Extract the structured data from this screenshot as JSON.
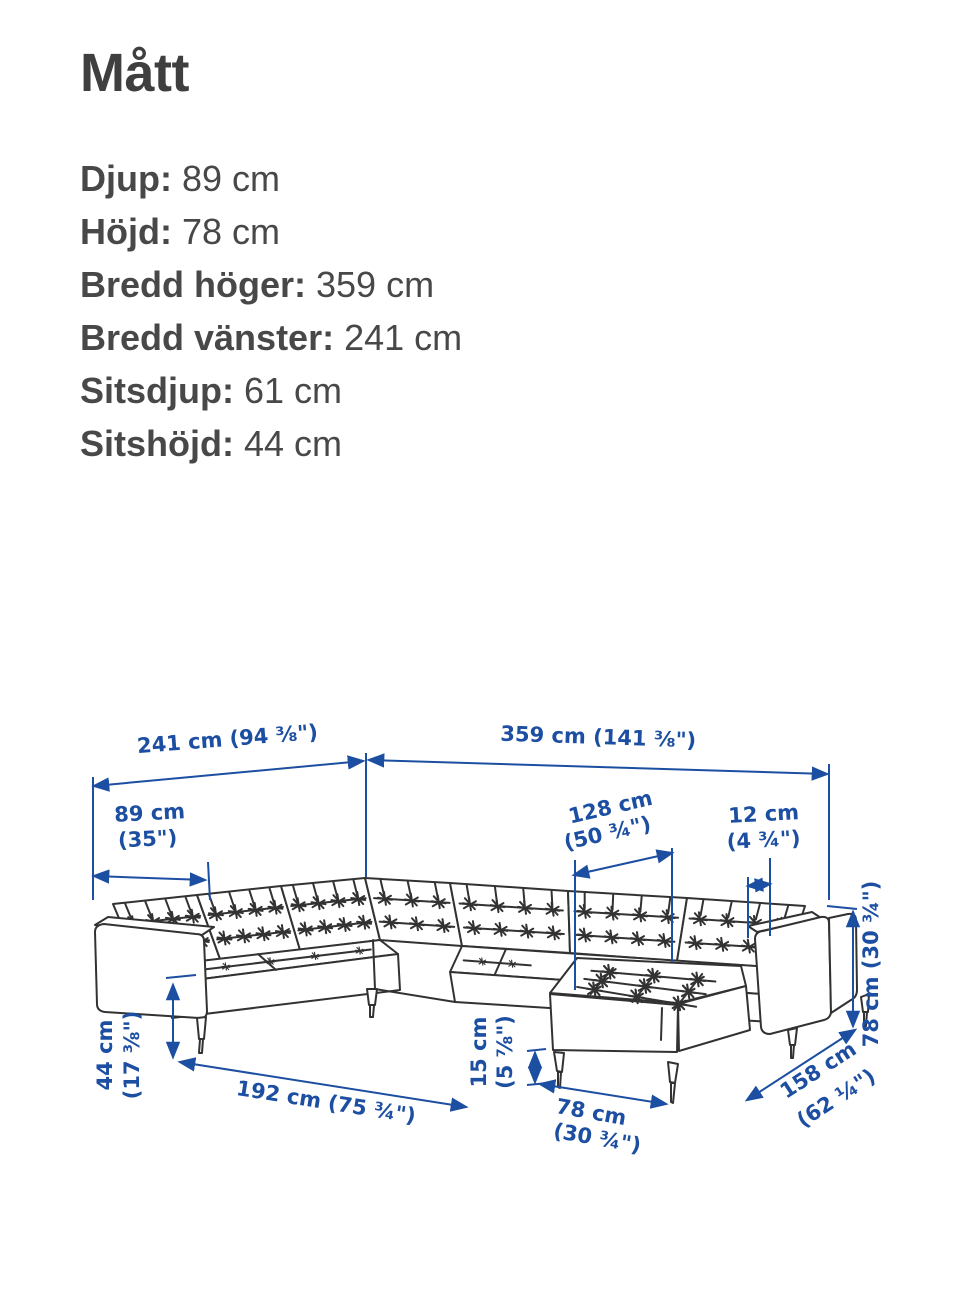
{
  "page": {
    "title": "Mått"
  },
  "specs": [
    {
      "label": "Djup:",
      "value": "89 cm"
    },
    {
      "label": "Höjd:",
      "value": "78 cm"
    },
    {
      "label": "Bredd höger:",
      "value": "359 cm"
    },
    {
      "label": "Bredd vänster:",
      "value": "241 cm"
    },
    {
      "label": "Sitsdjup:",
      "value": "61 cm"
    },
    {
      "label": "Sitshöjd:",
      "value": "44 cm"
    }
  ],
  "diagram": {
    "accent_color": "#1c4ea1",
    "line_color": "#323232",
    "dims": {
      "width_left": {
        "text": "241 cm (94 ⅜\")"
      },
      "width_right": {
        "text": "359 cm (141 ⅜\")"
      },
      "depth": {
        "line1": "89 cm",
        "line2": "(35\")"
      },
      "chaise_length": {
        "line1": "128 cm",
        "line2": "(50 ¾\")"
      },
      "gap": {
        "line1": "12 cm",
        "line2": "(4 ¾\")"
      },
      "seat_height": {
        "line1": "44 cm",
        "line2": "(17 ⅜\")"
      },
      "inner_width": {
        "text": "192 cm (75 ¾\")"
      },
      "leg_height": {
        "line1": "15 cm",
        "line2": "(5 ⅞\")"
      },
      "chaise_width": {
        "line1": "78 cm",
        "line2": "(30 ¾\")"
      },
      "depth_right": {
        "line1": "158 cm",
        "line2": "(62 ¼\")"
      },
      "height": {
        "text": "78 cm (30 ¾\")"
      }
    }
  }
}
